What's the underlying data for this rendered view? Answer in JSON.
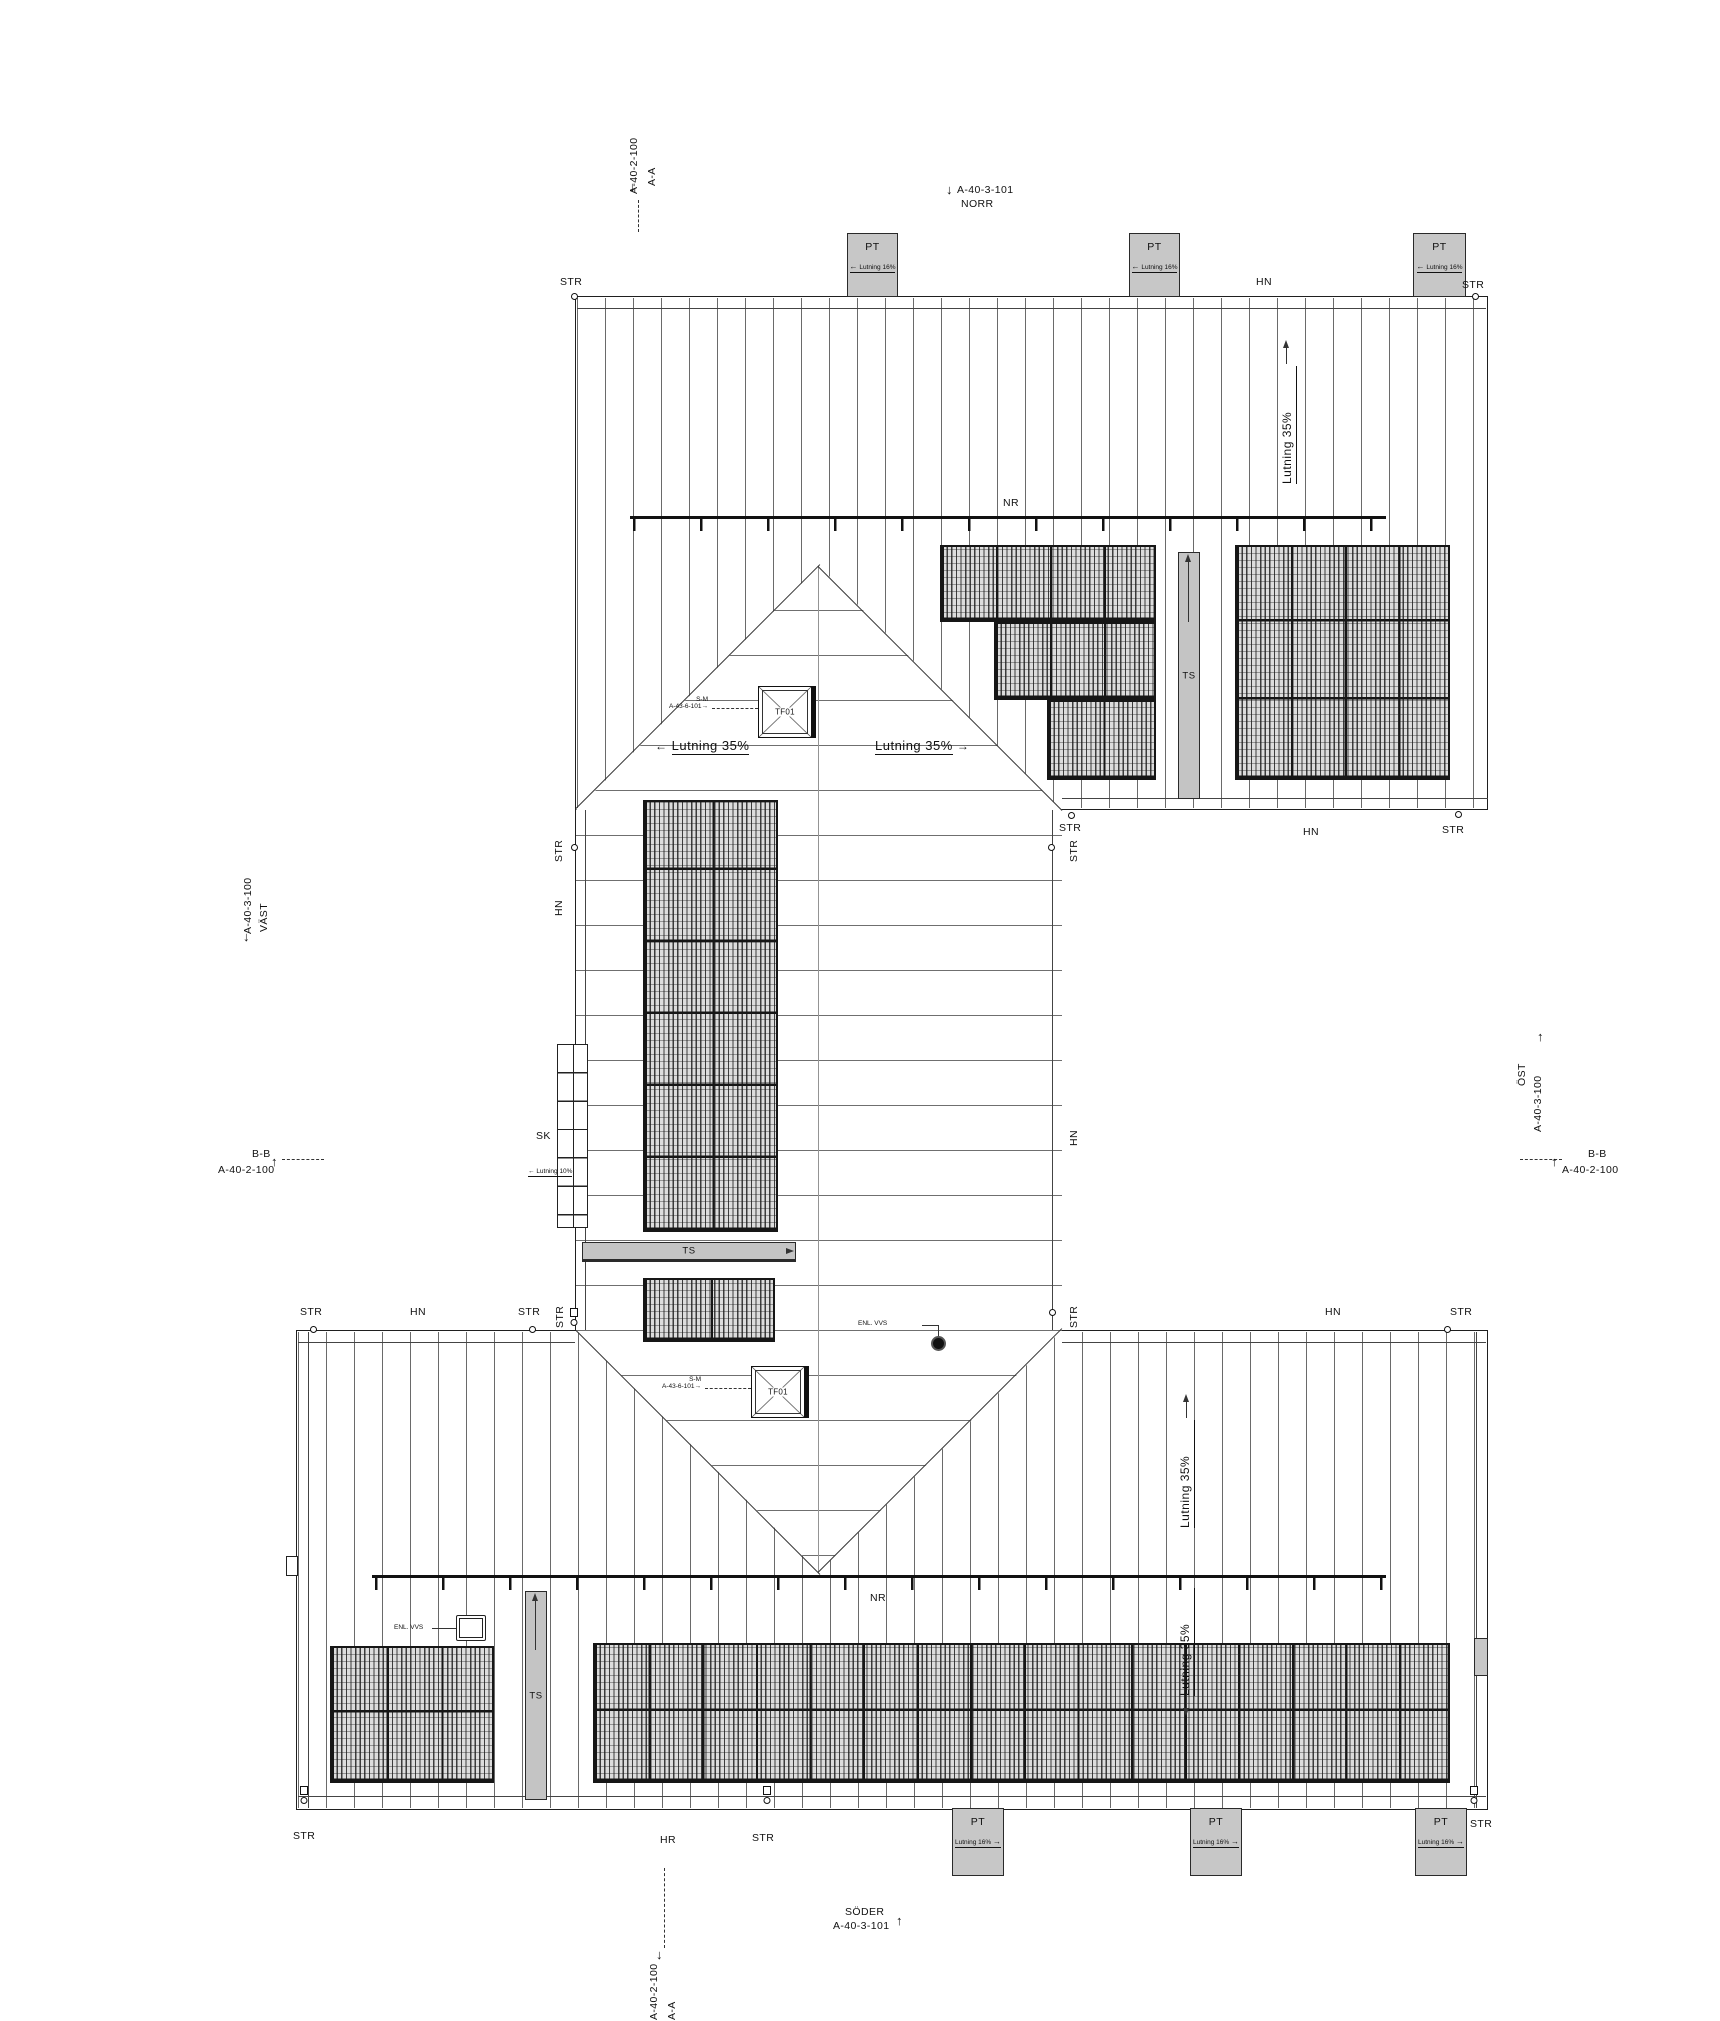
{
  "labels": {
    "pt": "PT",
    "ts": "TS",
    "nr": "NR",
    "str": "STR",
    "hn": "HN",
    "hr": "HR",
    "sk": "SK",
    "tf01": "TF01",
    "enl_vvs": "ENL. VVS"
  },
  "slopes": {
    "roof": "Lutning 35%",
    "terrace": "Lutning 16%",
    "walkway": "Lutning 10%"
  },
  "skylight_ref": {
    "line1": "S-M",
    "line2": "A-43-6-101"
  },
  "markers": {
    "aa_top": {
      "ref": "A-40-2-100",
      "name": "A-A",
      "arrow": "↓"
    },
    "aa_bottom": {
      "ref": "A-40-2-100",
      "name": "A-A",
      "arrow": "↓"
    },
    "bb_left": {
      "ref": "A-40-2-100",
      "name": "B-B",
      "arrow": "↑"
    },
    "bb_right": {
      "ref": "A-40-2-100",
      "name": "B-B",
      "arrow": "↑"
    },
    "north": {
      "ref": "A-40-3-101",
      "name": "NORR",
      "arrow": "↓"
    },
    "south": {
      "ref": "A-40-3-101",
      "name": "SÖDER",
      "arrow": "↑"
    },
    "west": {
      "ref": "A-40-3-100",
      "name": "VÄST",
      "arrow": "↓"
    },
    "east": {
      "ref": "A-40-3-100",
      "name": "ÖST",
      "arrow": "↑"
    }
  },
  "arrows": {
    "left": "←",
    "right": "→",
    "up": "↑",
    "down": "↓"
  },
  "colors": {
    "line": "#1a1a1a",
    "fill_gray": "#c7c7c7"
  }
}
